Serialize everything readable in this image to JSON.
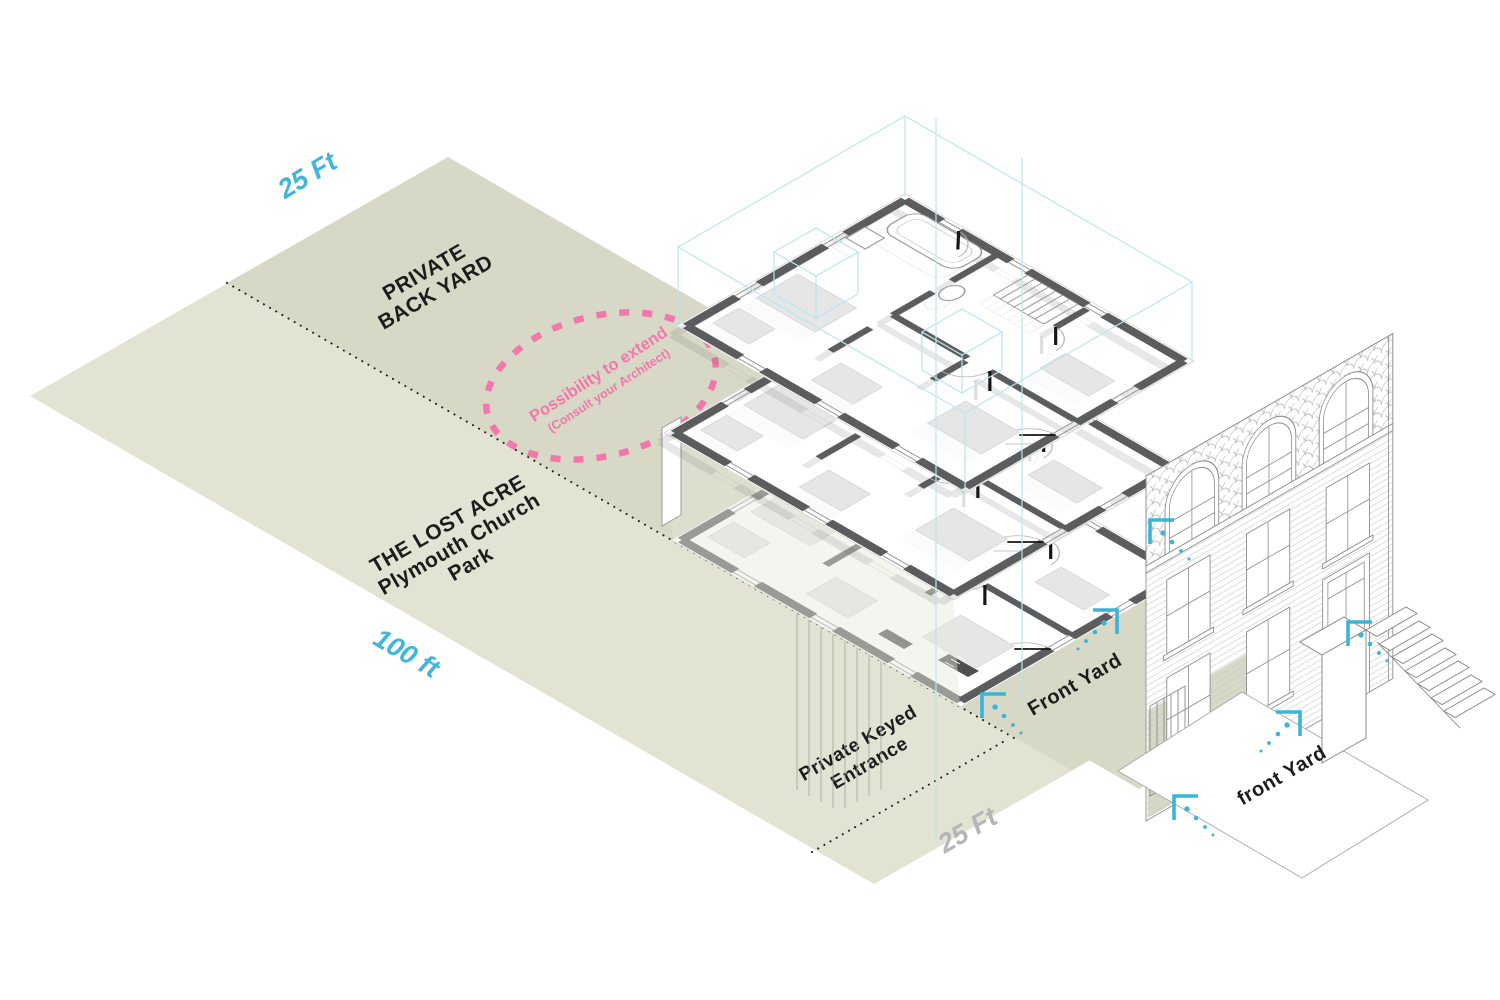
{
  "diagram_title": "Townhouse lot axonometric diagram",
  "labels": {
    "dim_top": "25 Ft",
    "back1": "PRIVATE",
    "back2": "BACK YARD",
    "ext1": "Possibility to extend",
    "ext2": "(Consult your Architect)",
    "park1": "THE LOST ACRE",
    "park2": "Plymouth Church",
    "park3": "Park",
    "dim_len": "100 ft",
    "key1": "Private Keyed",
    "key2": "Entrance",
    "dim_front": "25 Ft",
    "front_yard": "Front Yard",
    "front_yard_lower": "front Yard"
  },
  "colors": {
    "park_green": "#e2e3d3",
    "backyard_green": "#d7d8c5",
    "dimension_cyan": "#41b6d9",
    "dimension_gray": "#b5b5b5",
    "annotation_pink": "#f277ab",
    "wall_gray": "#5b5c5e",
    "wireframe_cyan": "#b9e6f2",
    "text_black": "#1c1c1c"
  },
  "icons": {
    "entry_arrow": "cyan corner bracket with dotted approach trail"
  }
}
